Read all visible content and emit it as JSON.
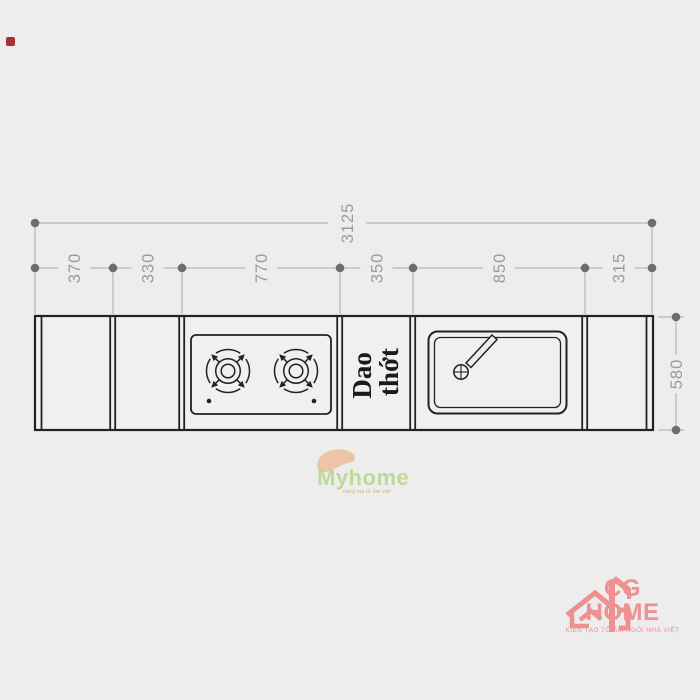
{
  "page": {
    "background": "#ededed"
  },
  "drawing": {
    "total_width_label": "3125",
    "segment_labels": [
      "370",
      "330",
      "770",
      "350",
      "850",
      "315"
    ],
    "depth_label": "580",
    "board_label": {
      "line1": "Dao",
      "line2": "thớt"
    },
    "colors": {
      "outline": "#222222",
      "dim_line": "#b6b6b6",
      "dim_dot": "#6d6d6d",
      "dim_text": "#9b9b9b"
    }
  },
  "watermark": {
    "name": "Myhome",
    "tagline": "nâng niu tổ ấm việt",
    "name_color": "#b7d68b",
    "tagline_color": "#dd9a62",
    "swoosh_color": "#ecbfa0"
  },
  "logo": {
    "name": "CG HOME",
    "tagline": "KIẾN TẠO TỔ ẤM NGÔI NHÀ VIỆT",
    "color": "#ee8f91"
  },
  "marker": {
    "color": "#a63232"
  }
}
